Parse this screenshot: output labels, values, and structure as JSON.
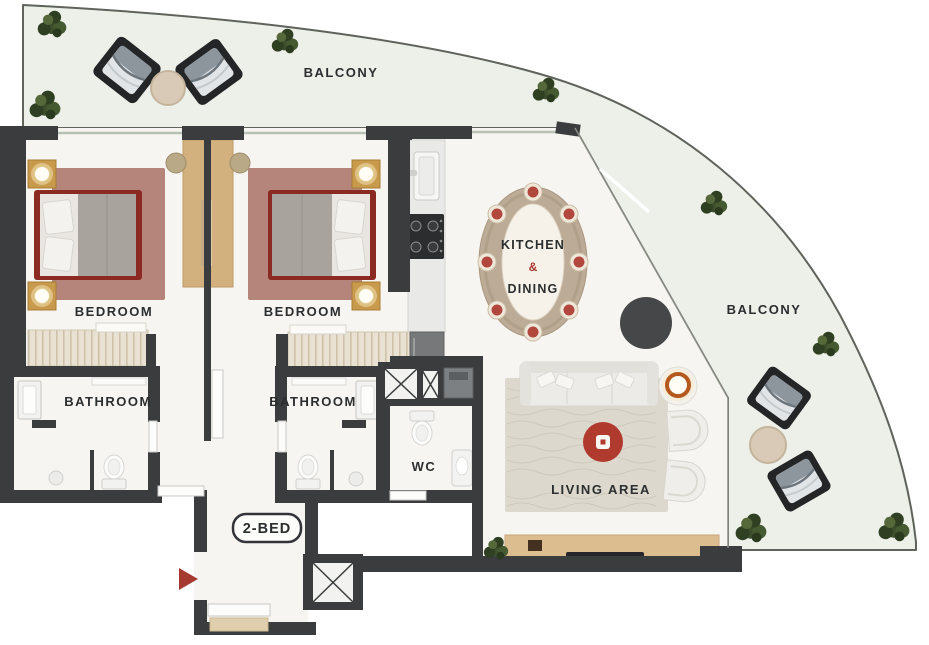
{
  "plan": {
    "unit_label": "2-BED",
    "labels": {
      "balcony_top": "BALCONY",
      "balcony_right": "BALCONY",
      "bedroom_left": "BEDROOM",
      "bedroom_right": "BEDROOM",
      "bathroom_left": "BATHROOM",
      "bathroom_right": "BATHROOM",
      "kitchen_line1": "KITCHEN",
      "kitchen_amp": "&",
      "kitchen_line2": "DINING",
      "wc": "WC",
      "living_area": "LIVING AREA"
    },
    "colors": {
      "wall": "#3a3c3e",
      "interior_floor": "#f7f5f1",
      "balcony_floor": "#edefe9",
      "outer_outline": "#60635c",
      "label_text": "#2b2e2f",
      "accent_red": "#a8342c",
      "bed_frame": "#8a2a22",
      "bedroom_rug": "#b5847b",
      "coffee_table_red": "#b13a2f",
      "desk_wood": "#d2b17e",
      "nightstand_gold": "#c89a4b",
      "tv_console_wood": "#dcbd8f",
      "plant_green": "#3c4e2c",
      "entrance_arrow_red": "#a63a31"
    },
    "icons": {
      "entrance_arrow": "entrance-arrow-icon",
      "service_shaft": "shaft-cross-icon",
      "stove": "stove-icon",
      "kitchen_sink": "sink-icon",
      "toilet": "toilet-icon",
      "floor_lamp": "floor-lamp-icon",
      "plant": "plant-icon"
    }
  }
}
